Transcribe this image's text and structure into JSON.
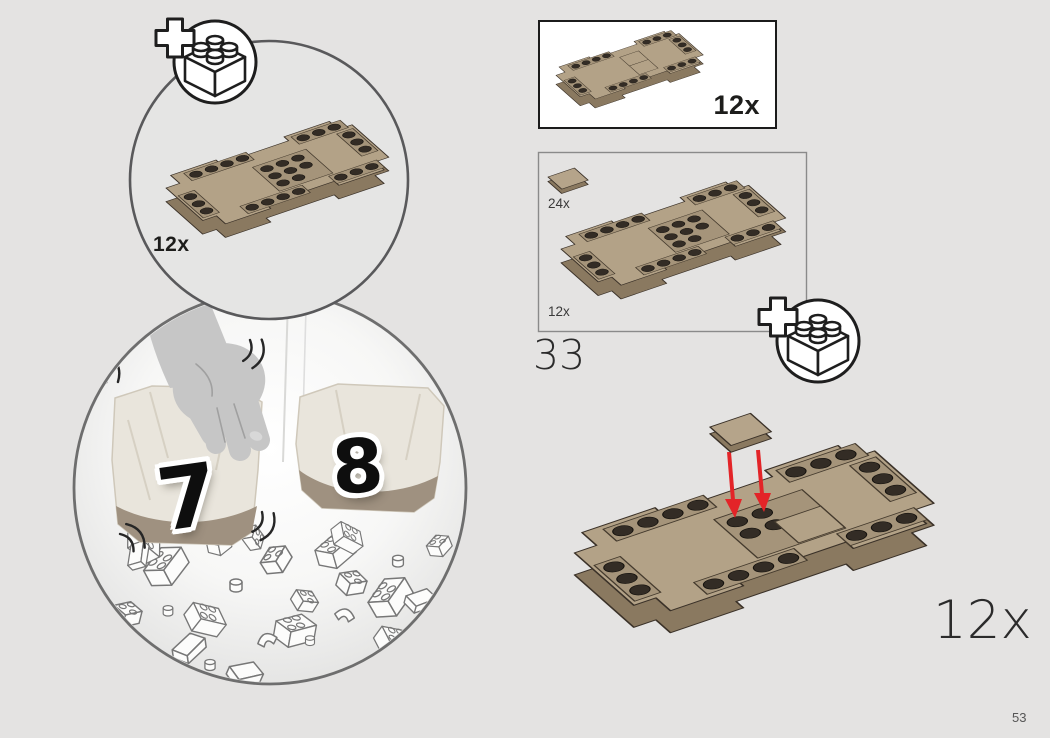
{
  "page": {
    "number": "53",
    "background_color": "#e4e3e2",
    "footer_strip_color": "#ffffff"
  },
  "colors": {
    "plate_tan_top": "#b3a287",
    "plate_tan_side": "#8a7960",
    "dark_outline": "#3a3128",
    "arrow_red": "#e32428",
    "bubble_border": "#6e6e6e"
  },
  "top_bubble": {
    "icon": "plus-brick-icon",
    "quantity_label": "12x",
    "content": "tan-plate-assembly"
  },
  "bag_bubble": {
    "bag_left_number": "7",
    "bag_right_number": "8",
    "content": "hand-shaking-bags-with-falling-bricks"
  },
  "parts_callout_box": {
    "quantity_label": "12x",
    "content": "tan-plate-assembly-with-tiles"
  },
  "step_box": {
    "step_number": "33",
    "tile_quantity_label": "24x",
    "plate_quantity_label": "12x",
    "icon": "plus-brick-icon"
  },
  "assembly": {
    "quantity_label": "12x",
    "content": "tile-placed-on-plate-with-red-arrows"
  }
}
